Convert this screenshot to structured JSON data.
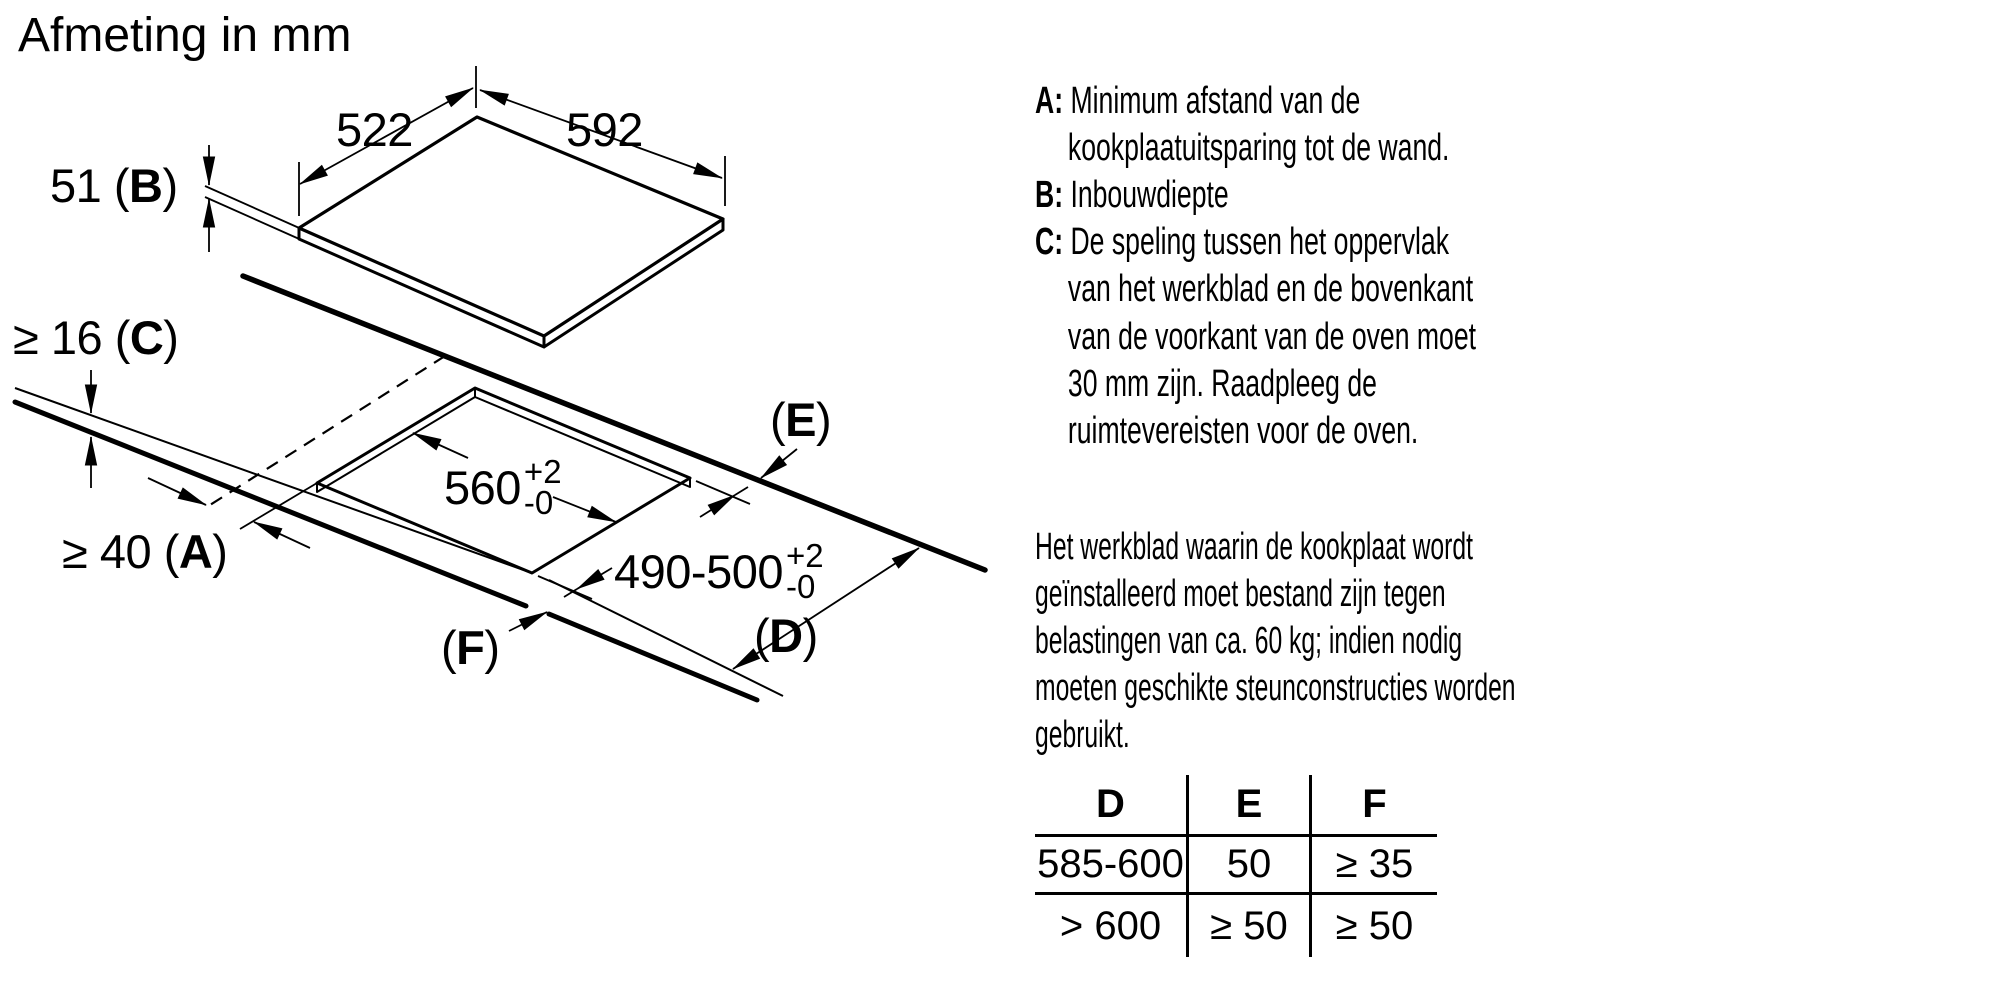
{
  "title": "Afmeting in mm",
  "colors": {
    "ink": "#000000",
    "background": "#ffffff"
  },
  "diagram": {
    "dim_top_left": "522",
    "dim_top_right": "592",
    "dim_b": {
      "pre": "51 (",
      "letter": "B",
      "post": ")"
    },
    "dim_c": {
      "pre": "≥ 16 (",
      "letter": "C",
      "post": ")"
    },
    "dim_a": {
      "pre": "≥ 40 (",
      "letter": "A",
      "post": ")"
    },
    "cutout_width": {
      "main": "560",
      "tol_plus": "+2",
      "tol_minus": "-0"
    },
    "cutout_depth": {
      "main": "490-500",
      "tol_plus": "+2",
      "tol_minus": "-0"
    },
    "label_e": {
      "pre": "(",
      "letter": "E",
      "post": ")"
    },
    "label_d": {
      "pre": "(",
      "letter": "D",
      "post": ")"
    },
    "label_f": {
      "pre": "(",
      "letter": "F",
      "post": ")"
    }
  },
  "legend": {
    "items": [
      {
        "letter_label": "A: ",
        "text": "Minimum afstand van de kookplaatuitsparing tot de wand."
      },
      {
        "letter_label": "B: ",
        "text": "Inbouwdiepte"
      },
      {
        "letter_label": "C: ",
        "text": "De speling tussen het oppervlak van het werkblad en de bovenkant van de voorkant van de oven moet 30 mm zijn. Raadpleeg de ruimtevereisten voor de oven."
      }
    ]
  },
  "paragraph": "Het werkblad waarin de kookplaat wordt geïnstalleerd moet bestand zijn tegen belastingen van ca. 60 kg; indien nodig moeten geschikte steunconstructies worden gebruikt.",
  "table": {
    "headers": [
      "D",
      "E",
      "F"
    ],
    "rows": [
      [
        "585-600",
        "50",
        "≥ 35"
      ],
      [
        "> 600",
        "≥ 50",
        "≥ 50"
      ]
    ]
  }
}
